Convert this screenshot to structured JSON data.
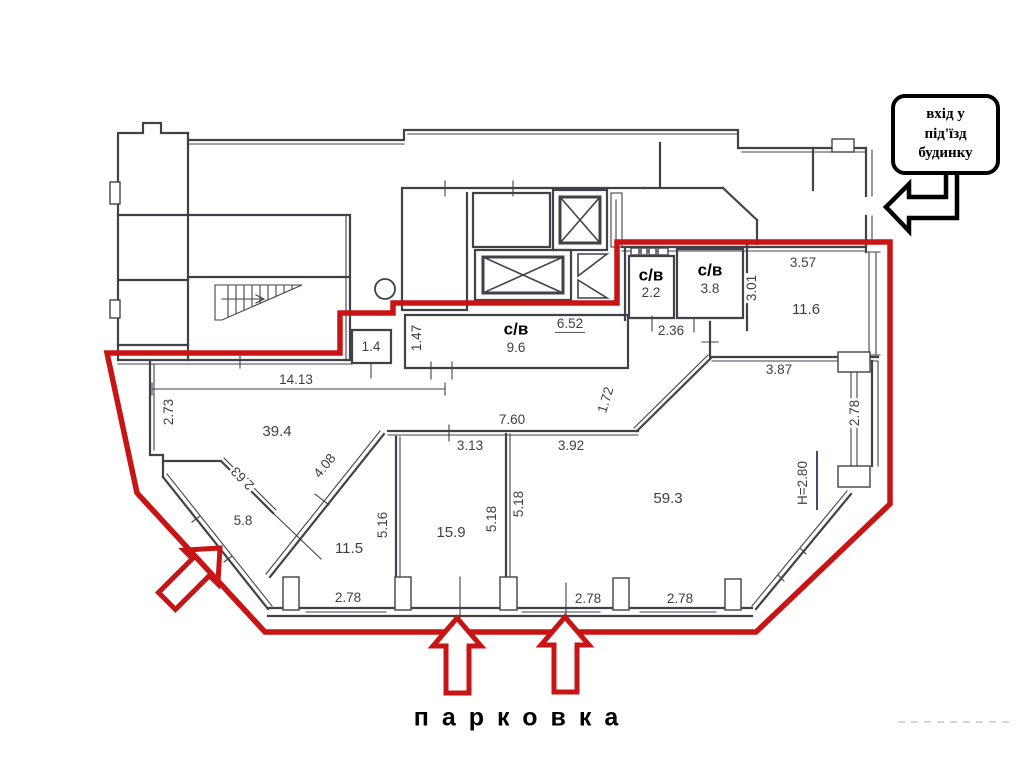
{
  "colors": {
    "red_outline": "#c81414",
    "wall": "#41414a",
    "ink": "#000000",
    "dim_text": "#3e3e46"
  },
  "callout": {
    "line1": "вхід у",
    "line2": "під'їзд",
    "line3": "будинку"
  },
  "parking_label": "парковка",
  "bathrooms": {
    "sv1": {
      "label": "с/в",
      "area": "2.2"
    },
    "sv2": {
      "label": "с/в",
      "area": "3.8"
    },
    "sv3": {
      "label": "с/в",
      "area": "9.6"
    }
  },
  "room_areas": {
    "r11_6": "11.6",
    "r1_4": "1.4",
    "r39_4": "39.4",
    "r5_8": "5.8",
    "r11_5": "11.5",
    "r15_9": "15.9",
    "r59_3": "59.3"
  },
  "dimensions": {
    "d3_57": "3.57",
    "d3_01": "3.01",
    "d2_36": "2.36",
    "d6_52": "6.52",
    "d3_87": "3.87",
    "d1_47": "1.47",
    "d14_13": "14.13",
    "d2_73": "2.73",
    "d1_72": "1.72",
    "d7_60": "7.60",
    "d3_13": "3.13",
    "d3_92": "3.92",
    "d4_08": "4.08",
    "d2_63": "2.63",
    "d5_16": "5.16",
    "d5_18_left": "5.18",
    "d5_18_right": "5.18",
    "d_height": "H=2.80",
    "d2_78_right": "2.78",
    "d2_78_bottom1": "2.78",
    "d2_78_bottom2": "2.78",
    "d2_78_bottom3": "2.78"
  }
}
